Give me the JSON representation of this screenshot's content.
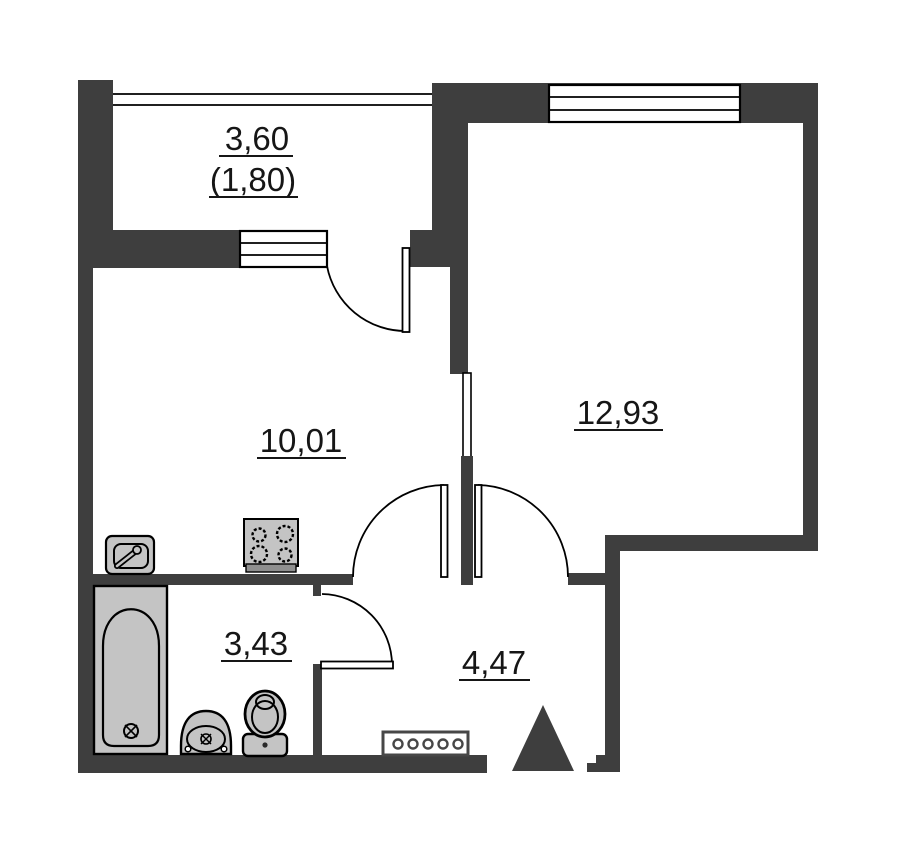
{
  "plan": {
    "type": "apartment-floor-plan",
    "colors": {
      "wall": "#3e3e3e",
      "fixture": "#c4c4c4",
      "outline": "#000000",
      "text": "#161616",
      "background": "#ffffff"
    },
    "rooms": {
      "balcony": {
        "area": "3,60",
        "area_coefficient": "(1,80)"
      },
      "kitchen": {
        "area": "10,01"
      },
      "living": {
        "area": "12,93"
      },
      "bathroom": {
        "area": "3,43"
      },
      "hallway": {
        "area": "4,47"
      }
    }
  }
}
